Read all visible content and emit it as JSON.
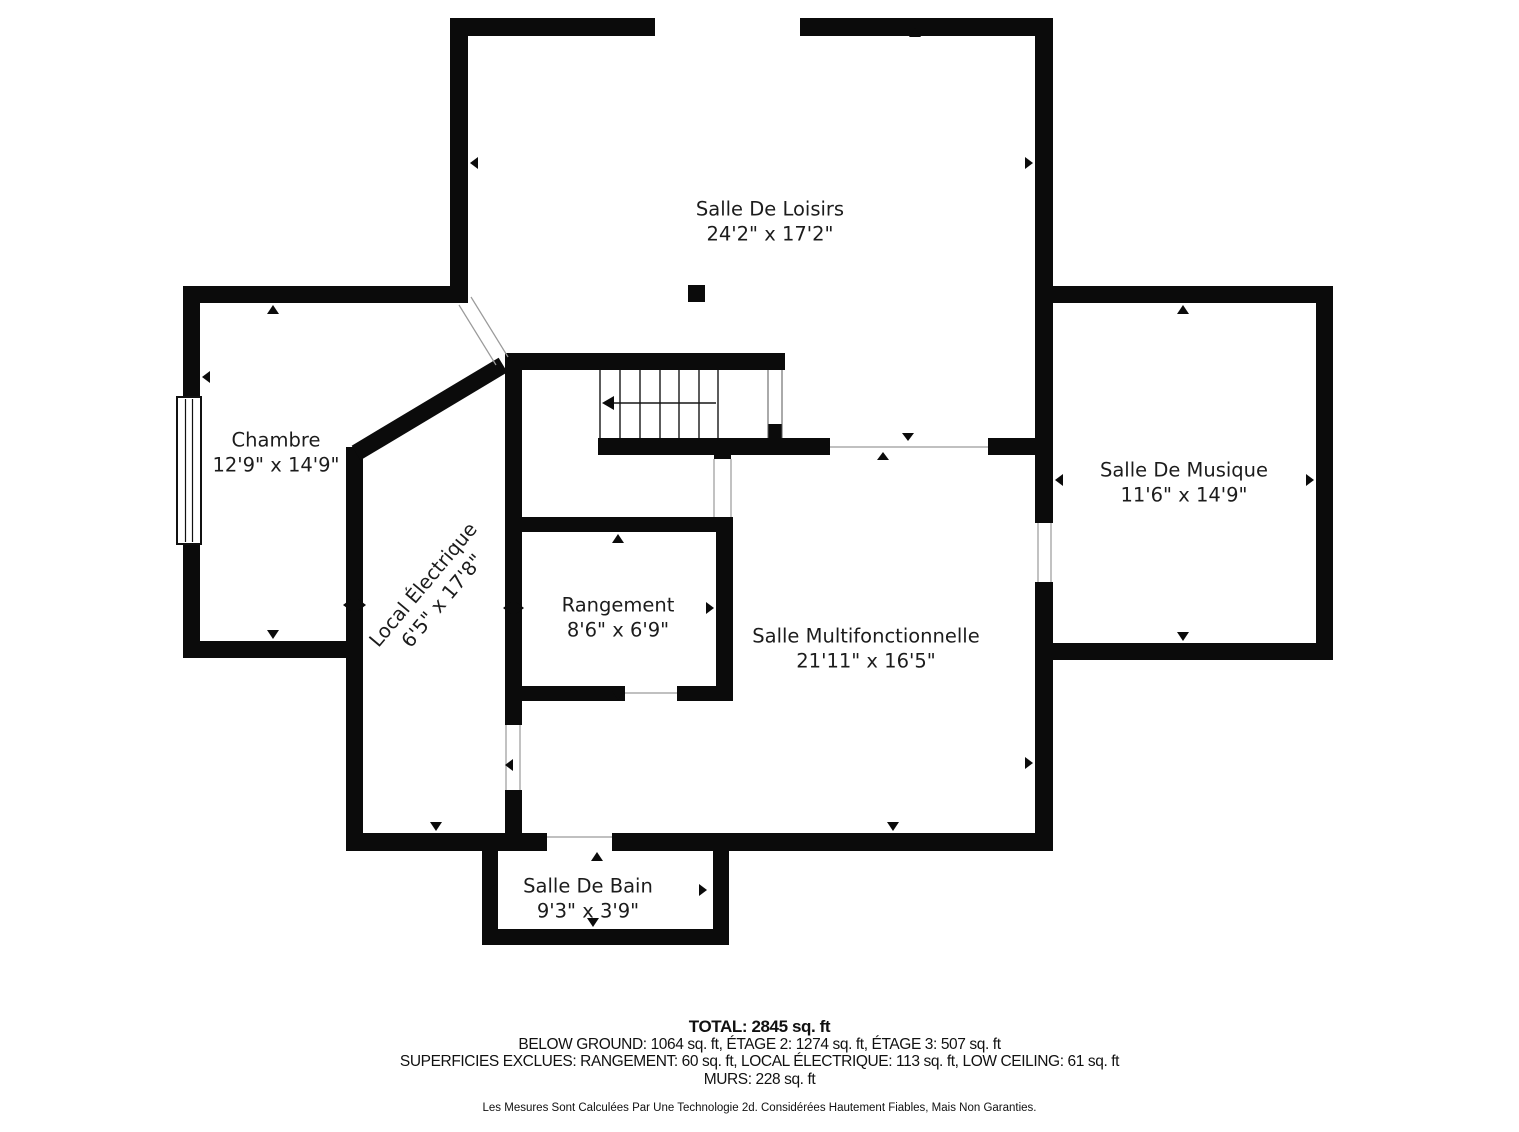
{
  "colors": {
    "background": "#ffffff",
    "wall": "#0b0b0b",
    "text": "#1c1c1c"
  },
  "rooms": [
    {
      "id": "salle-de-loisirs",
      "name": "Salle De Loisirs",
      "dimensions": "24'2\" x 17'2\""
    },
    {
      "id": "chambre",
      "name": "Chambre",
      "dimensions": "12'9\" x 14'9\""
    },
    {
      "id": "salle-de-musique",
      "name": "Salle De Musique",
      "dimensions": "11'6\" x 14'9\""
    },
    {
      "id": "local-electrique",
      "name": "Local Électrique",
      "dimensions": "6'5\" x 17'8\""
    },
    {
      "id": "rangement",
      "name": "Rangement",
      "dimensions": "8'6\" x 6'9\""
    },
    {
      "id": "salle-multifonctionnelle",
      "name": "Salle Multifonctionnelle",
      "dimensions": "21'11\" x 16'5\""
    },
    {
      "id": "salle-de-bain",
      "name": "Salle De Bain",
      "dimensions": "9'3\" x 3'9\""
    }
  ],
  "summary": {
    "total": "TOTAL: 2845 sq. ft",
    "floors": "BELOW GROUND: 1064 sq. ft, ÉTAGE 2: 1274 sq. ft, ÉTAGE 3: 507 sq. ft",
    "excluded": "SUPERFICIES EXCLUES: RANGEMENT: 60 sq. ft, LOCAL ÉLECTRIQUE: 113 sq. ft, LOW CEILING: 61 sq. ft",
    "walls": "MURS: 228 sq. ft"
  },
  "disclaimer": "Les Mesures Sont Calculées Par Une Technologie 2d. Considérées Hautement Fiables, Mais Non Garanties."
}
